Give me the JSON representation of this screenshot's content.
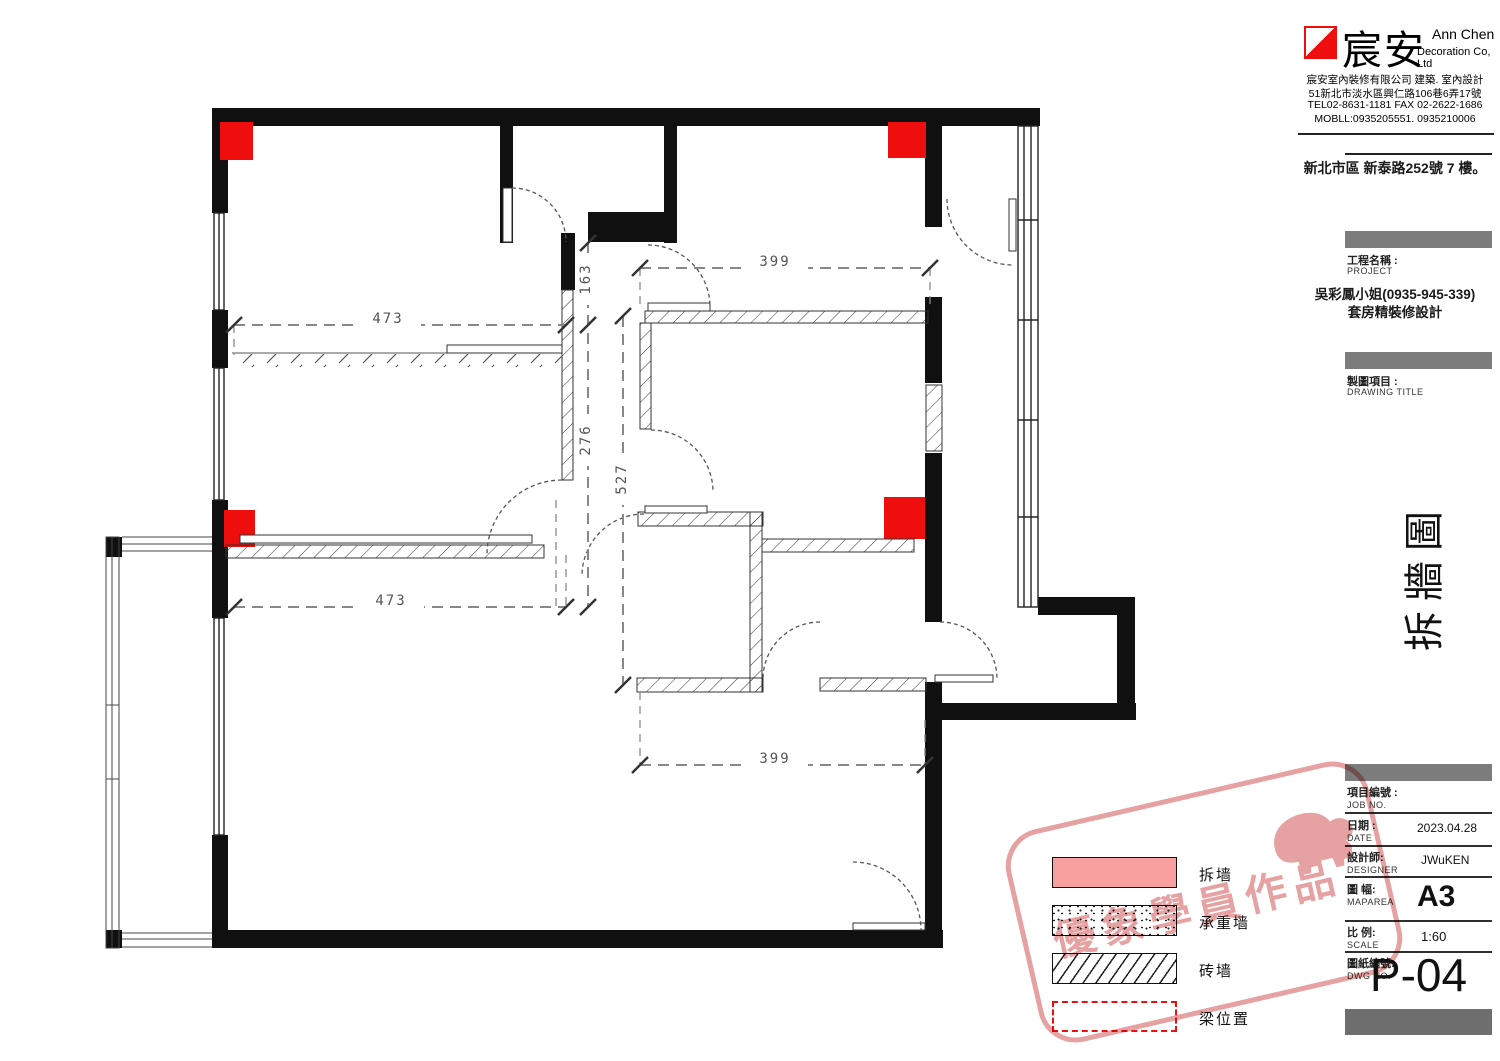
{
  "colors": {
    "red": "#ee0e0e",
    "demolish_pink": "#f8a0a0",
    "watermark": "#d25555",
    "wall_black": "#101010",
    "dim_gray": "#555555"
  },
  "company": {
    "logo_text": "宸安",
    "name_en1": "Ann Chen",
    "name_en2": "Decoration Co, Ltd",
    "info_lines": [
      "宸安室內裝修有限公司 建築. 室內設計",
      "51新北市淡水區興仁路106巷6弄17號",
      "TEL02-8631-1181 FAX 02-2622-1686",
      "MOBLL:0935205551. 0935210006"
    ],
    "site_address": "新北市區 新泰路252號 7 樓。"
  },
  "project": {
    "label_zh": "工程名稱 :",
    "label_en": "PROJECT",
    "client": "吳彩鳳小姐(0935-945-339)",
    "description": "套房精裝修設計"
  },
  "drawing": {
    "label_zh": "製圖項目 :",
    "label_en": "DRAWING TITLE",
    "title_vertical": "拆牆圖"
  },
  "title_block": {
    "rows": [
      {
        "zh": "項目編號 :",
        "en": "JOB NO.",
        "value": ""
      },
      {
        "zh": "日期 :",
        "en": "DATE",
        "value": "2023.04.28"
      },
      {
        "zh": "設計師:",
        "en": "DESIGNER",
        "value": "JWuKEN"
      },
      {
        "zh": "圖 幅:",
        "en": "MAPAREA",
        "value": "A3"
      },
      {
        "zh": "比 例:",
        "en": "SCALE",
        "value": "1:60"
      },
      {
        "zh": "圖紙編號:",
        "en": "DWG NO.",
        "value": ""
      }
    ],
    "sheet_no": "P-04"
  },
  "legend": {
    "items": [
      {
        "label": "拆墙"
      },
      {
        "label": "承重墙"
      },
      {
        "label": "砖墙"
      },
      {
        "label": "梁位置"
      }
    ]
  },
  "watermark": {
    "text": "優象學員作品"
  },
  "dims": {
    "d473_top": "473",
    "d399_top": "399",
    "d163": "163",
    "d276": "276",
    "d527": "527",
    "d473_bottom": "473",
    "d399_bottom": "399"
  }
}
